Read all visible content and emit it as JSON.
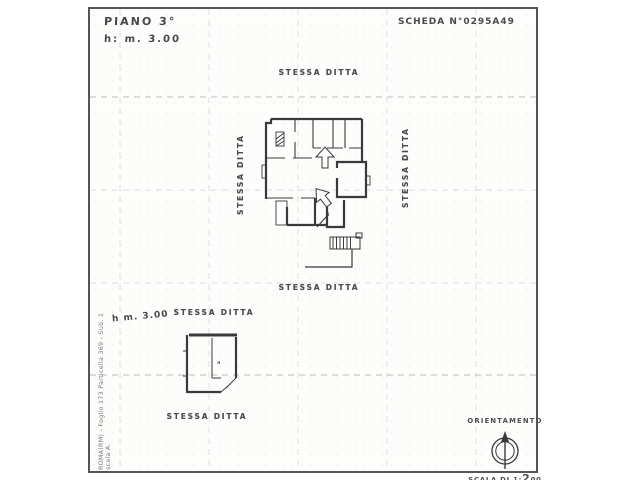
{
  "header": {
    "floor": "PIANO 3°",
    "height": "h: m. 3.00",
    "sheet": "SCHEDA N°0295A49"
  },
  "main_plan": {
    "label_top": "STESSA DITTA",
    "label_left": "STESSA DITTA",
    "label_right": "STESSA DITTA",
    "label_bottom": "STESSA DITTA",
    "room_label": "a"
  },
  "annex_plan": {
    "height": "h m. 3.00",
    "label_top": "STESSA DITTA",
    "label_bottom": "STESSA DITTA",
    "room_label": "a"
  },
  "orientation": {
    "title": "ORIENTAMENTO",
    "scale_prefix": "SCALA DI 1:",
    "scale_digit": "2",
    "scale_suffix": "00"
  },
  "watermark": {
    "line1": "ROMA(RM) - Foglio 173 Particella 369 - Sub. 1",
    "line2": "scala A."
  },
  "colors": {
    "ink": "#3a3a3a",
    "grid": "#b0b0b0",
    "paper": "#fdfdfc"
  }
}
